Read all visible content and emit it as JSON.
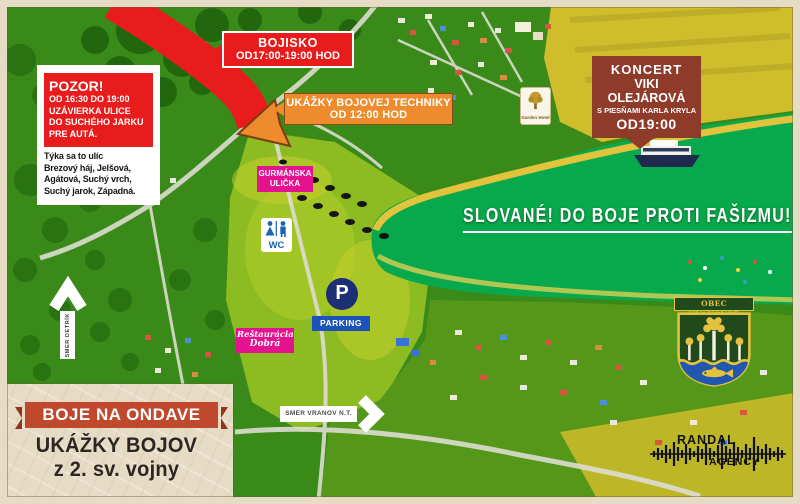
{
  "colors": {
    "paper": "#e6dbc5",
    "red": "#e81c1c",
    "orange": "#ee8c2d",
    "brick": "#8e3b2a",
    "magenta": "#e5128f",
    "navy": "#1c2f74",
    "blue": "#1d52bb",
    "wcBlue": "#1b63ad",
    "ribbon": "#c0482c",
    "ink": "#2b2620",
    "gold": "#e3c23f",
    "crestGreen": "#20491c",
    "water": "#08a84c"
  },
  "road_closure": {
    "title": "POZOR!",
    "schedule": "OD 16:30 DO 19:00",
    "line2": "UZÁVIERKA ULICE",
    "line3": "DO SUCHÉHO JARKU",
    "line4": "PRE AUTÁ.",
    "note1": "Týka sa to ulíc",
    "note2": "Brezový háj, Jelšová,",
    "note3": "Agátová, Suchý vrch,",
    "note4": "Suchý jarok, Západná."
  },
  "battlefield": {
    "name": "BOJISKO",
    "time": "OD17:00-19:00 HOD"
  },
  "tech_demo": {
    "name": "UKÁŽKY BOJOVEJ TECHNIKY",
    "time": "OD 12:00 HOD"
  },
  "concert": {
    "name": "KONCERT",
    "artist": "VIKI OLEJÁROVÁ",
    "subtitle": "S PIESŇAMI KARLA KRYLA",
    "time": "OD19:00"
  },
  "slogan": "SLOVANÉ! DO BOJE PROTI FAŠIZMU!",
  "food_street": {
    "line1": "GURMÁNSKA",
    "line2": "ULIČKA"
  },
  "restaurant": {
    "line1": "Reštaurácia",
    "line2": "Dobrá"
  },
  "wc_label": "WC",
  "parking": {
    "symbol": "P",
    "label": "PARKING"
  },
  "directions": {
    "detrik": "SMER DETRÍK",
    "vranov": "SMER VRANOV N.T."
  },
  "garden_hotel": "Garden Hotel",
  "municipality": "OBEC KVAKOVCE",
  "agency": {
    "line1": "RANDAL",
    "line2": "AGENCY"
  },
  "banner": {
    "ribbon": "BOJE NA ONDAVE",
    "title1": "UKÁŽKY BOJOV",
    "title2": "z 2. sv. vojny"
  }
}
